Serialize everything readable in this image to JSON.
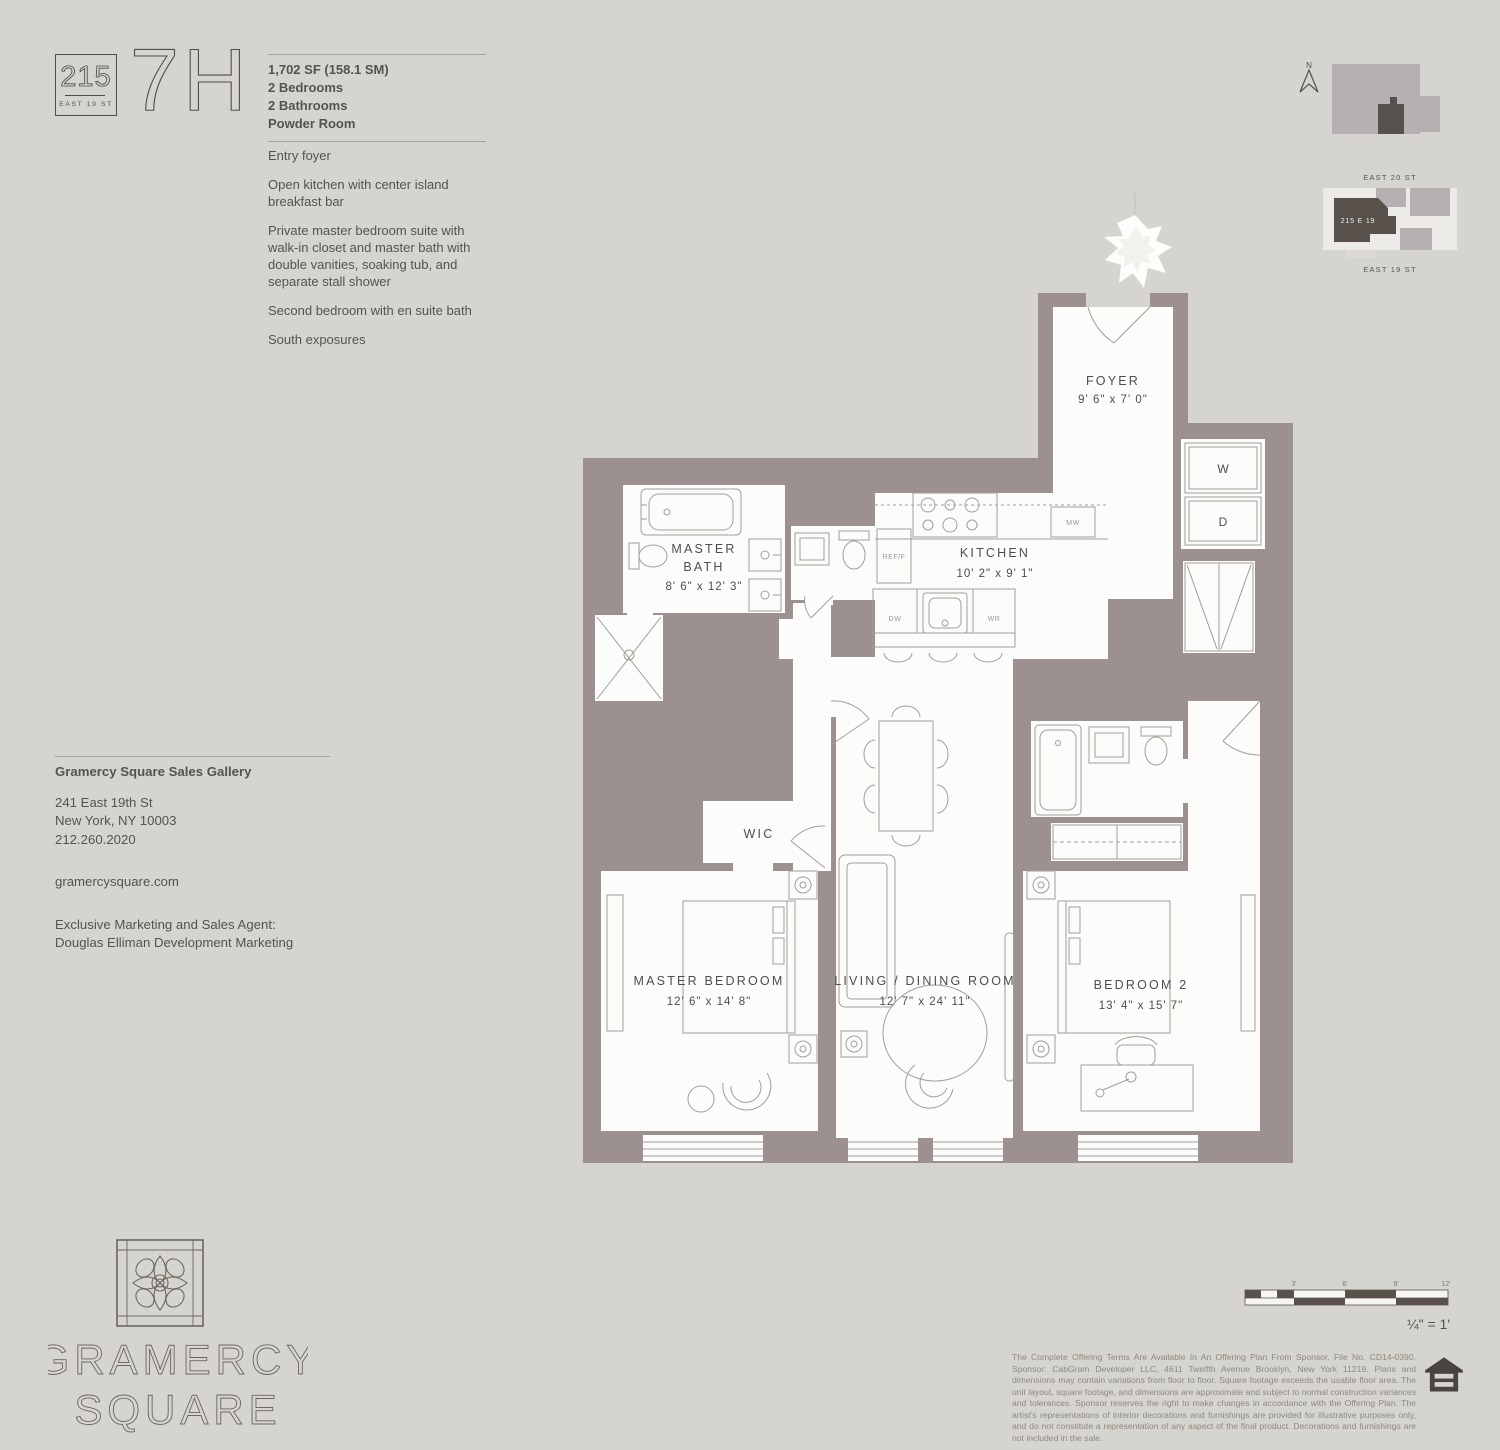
{
  "colors": {
    "background": "#d6d4cf",
    "wall": "#9c9091",
    "room_fill": "#fcfcfb",
    "dark_accent": "#57504b",
    "map_building_light": "#b7b0b2",
    "text": "#55534f"
  },
  "header": {
    "address_number": "215",
    "address_street": "EAST 19 ST",
    "unit": "7H",
    "area": "1,702 SF (158.1 SM)",
    "specs": [
      "2 Bedrooms",
      "2 Bathrooms",
      "Powder Room"
    ],
    "features": [
      "Entry foyer",
      "Open kitchen with center island breakfast bar",
      "Private master bedroom suite with walk-in closet and master bath with double vanities, soaking tub, and separate stall shower",
      "Second bedroom with en suite bath",
      "South exposures"
    ]
  },
  "locator": {
    "compass": "N",
    "street_top": "EAST 20 ST",
    "street_bottom": "EAST 19 ST",
    "building": "215 E 19"
  },
  "plan": {
    "rooms": {
      "foyer": {
        "label": "FOYER",
        "dims": "9' 6\" x 7' 0\""
      },
      "kitchen": {
        "label": "KITCHEN",
        "dims": "10' 2\" x 9' 1\""
      },
      "master_bath": {
        "label_line1": "MASTER",
        "label_line2": "BATH",
        "dims": "8' 6\" x 12' 3\""
      },
      "wic": {
        "label": "WIC"
      },
      "master_bedroom": {
        "label": "MASTER BEDROOM",
        "dims": "12' 6\" x 14' 8\""
      },
      "living_dining": {
        "label": "LIVING / DINING ROOM",
        "dims": "12' 7\" x 24' 11\""
      },
      "bedroom2": {
        "label": "BEDROOM 2",
        "dims": "13' 4\" x 15' 7\""
      }
    },
    "appliances": {
      "washer": "W",
      "dryer": "D",
      "microwave": "MW",
      "dishwasher": "DW",
      "wine_ref": "WR",
      "fridge": "REF/F"
    }
  },
  "contact": {
    "title": "Gramercy Square Sales Gallery",
    "address_line1": "241 East 19th St",
    "address_line2": "New York, NY 10003",
    "phone": "212.260.2020",
    "website": "gramercysquare.com",
    "agent_line1": "Exclusive Marketing and Sales Agent:",
    "agent_line2": "Douglas Elliman Development Marketing"
  },
  "brand": {
    "name_line1": "GRAMERCY",
    "name_line2": "SQUARE"
  },
  "scale": {
    "ticks": [
      "3'",
      "6'",
      "9'",
      "12'"
    ],
    "ratio": "¼\" = 1'"
  },
  "legal": {
    "disclaimer": "The Complete Offering Terms Are Available In An Offering Plan From Sponsor. File No. CD14-0390. Sponsor: CabGram Developer LLC, 4611 Twelfth Avenue Brooklyn, New York 11219. Plans and dimensions may contain variations from floor to floor. Square footage exceeds the usable floor area. The unit layout, square footage, and dimensions are approximate and subject to normal construction variances and tolerances. Sponsor reserves the right to make changes in accordance with the Offering Plan. The artist's representations of interior decorations and furnishings are provided for illustrative purposes only, and do not constitute a representation of any aspect of the final product. Decorations and furnishings are not included in the sale."
  }
}
